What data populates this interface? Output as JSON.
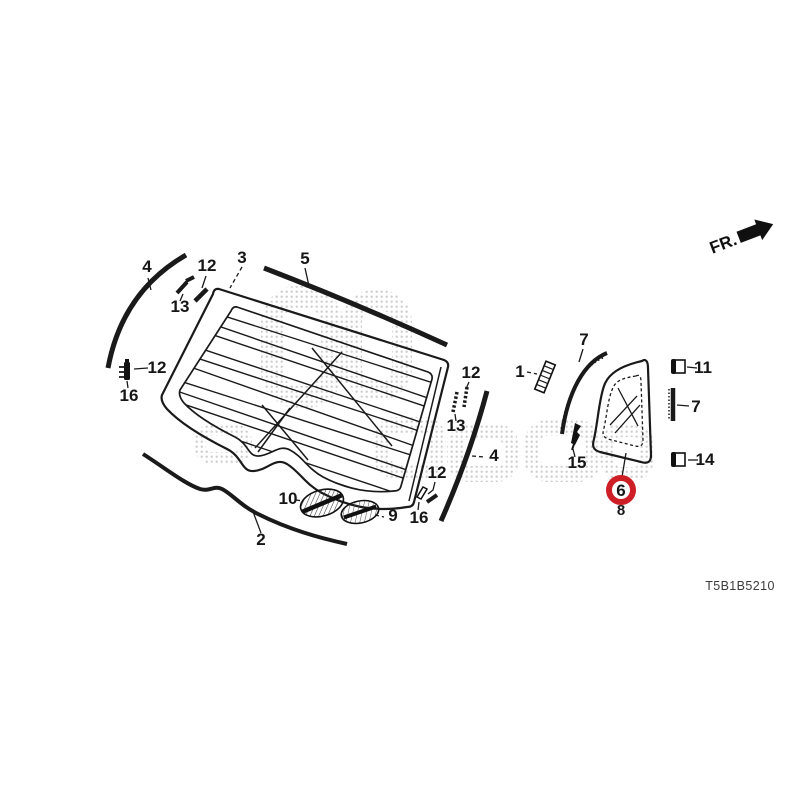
{
  "diagram": {
    "code": "T5B1B5210",
    "direction_label": "FR.",
    "colors": {
      "line": "#1a1a1a",
      "highlight": "#ce1f26",
      "watermark_dots": "#c4c4c4",
      "background": "#ffffff"
    }
  },
  "icons": {
    "fr_arrow": "solid-right-block-arrow",
    "watermark": "halftone-dot-logo-watermark"
  },
  "callouts": {
    "strip4_left": "4",
    "clip12_topleft": "12",
    "clip13_topleft": "13",
    "glass3": "3",
    "molding5": "5",
    "clip12_left": "12",
    "clip16_left": "16",
    "clip12_right": "12",
    "clip13_right": "13",
    "strip4_right": "4",
    "clip12_bottom": "12",
    "clip16_bottom": "16",
    "emblem10": "10",
    "emblem9": "9",
    "strip2": "2",
    "part1": "1",
    "molding7_top": "7",
    "clip15": "15",
    "glass6": "6",
    "seal8": "8",
    "clip11": "11",
    "strip7_right": "7",
    "clip14": "14"
  },
  "highlight": {
    "selected_callout": "6"
  }
}
